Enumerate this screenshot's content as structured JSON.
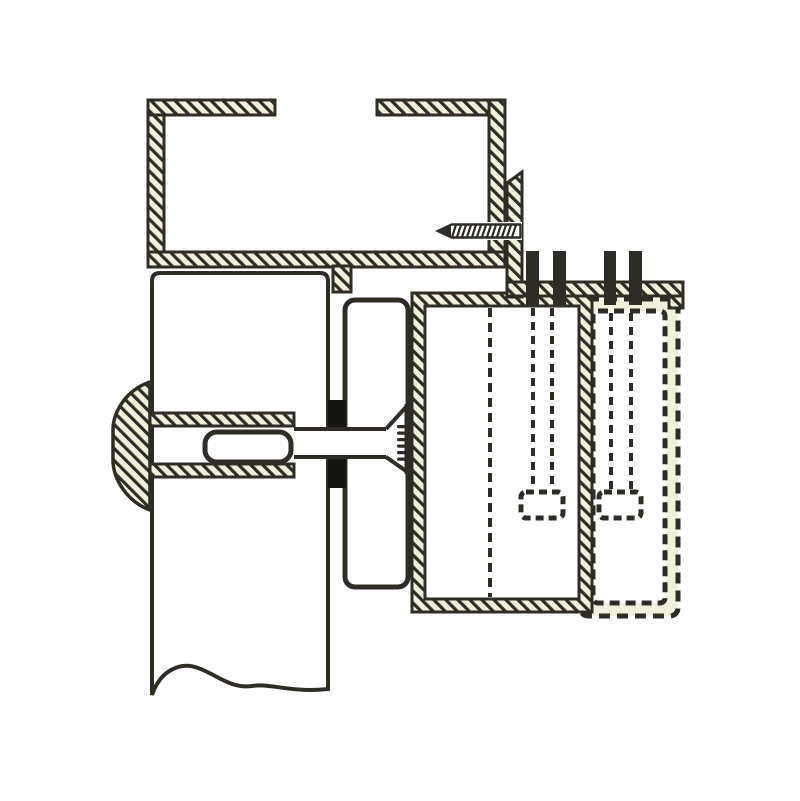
{
  "title": "Cross-section assembly diagram of a panel connector fitting on a hollow frame profile",
  "colors": {
    "ink": "#2e2c24",
    "cream": "#f2efdb",
    "paper": "#ffffff",
    "black": "#161612"
  },
  "diagram": {
    "type": "engineering-cross-section",
    "has_text_labels": false,
    "parts": [
      {
        "id": "top-rail-profile",
        "desc": "Hollow rectangular frame profile with hatched walls and a slot opening in the top wall"
      },
      {
        "id": "angle-bracket",
        "desc": "L-shaped hatched mounting bracket attached to the right wall of the profile"
      },
      {
        "id": "fixing-screw",
        "desc": "Horizontal self-tapping screw fastening the bracket to the profile wall"
      },
      {
        "id": "vertical-panel",
        "desc": "Vertical panel in section, broken off at the bottom with a wavy break line"
      },
      {
        "id": "dome-head-anchor",
        "desc": "Dome-headed connector bolt with slotted sleeve passing through the panel"
      },
      {
        "id": "spacer-gasket",
        "desc": "Solid black spacer between panel and clamping block"
      },
      {
        "id": "clamping-block",
        "desc": "Rounded clamping block with conical countersunk threaded seat"
      },
      {
        "id": "housing-solid",
        "desc": "Box housing in section (hatched border) with bolt and hidden nut shown dashed"
      },
      {
        "id": "housing-phantom",
        "desc": "Alternative housing position drawn as dashed phantom outline with bolt and nut"
      },
      {
        "id": "bolt-1",
        "desc": "Left vertical bolt through mounting flange, shank and nut hidden (dashed)"
      },
      {
        "id": "bolt-2",
        "desc": "Right vertical bolt through mounting flange, shank and nut hidden (dashed)"
      }
    ]
  }
}
